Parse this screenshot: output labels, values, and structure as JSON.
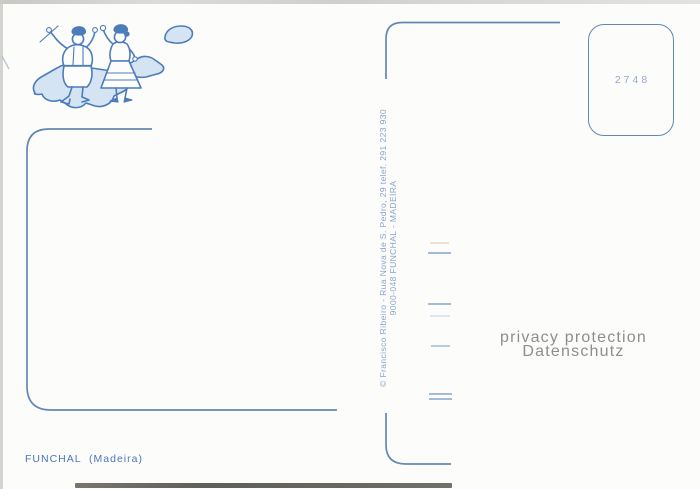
{
  "postcard": {
    "caption": "FUNCHAL  (Madeira)",
    "stamp_box": {
      "number": "2748"
    },
    "publisher_imprint": {
      "line1": "© Francisco Ribeiro - Rua Nova de S. Pedro, 29 telef. 291 223 930",
      "line2": "9000-048 FUNCHAL - MADEIRA"
    },
    "watermark": {
      "line1": "privacy protection",
      "line2": "Datenschutz"
    },
    "illustration": {
      "name": "madeira-map-with-folk-dancers-icon"
    }
  },
  "colors": {
    "paper": "#fcfcfa",
    "line_blue": "#6488b2",
    "art_blue": "#4d7cba",
    "map_fill": "#d5e4f3",
    "caption_blue": "#4a76bb",
    "imprint_blue": "#8ba4c9",
    "stamp_number_blue": "#93a9ce",
    "stub_blue": "#a3bbd8",
    "watermark_gray": "#8e8e8e",
    "scan_edge_gray": "#cbcbc7",
    "scan_bottom_dark": "#6b6862"
  }
}
